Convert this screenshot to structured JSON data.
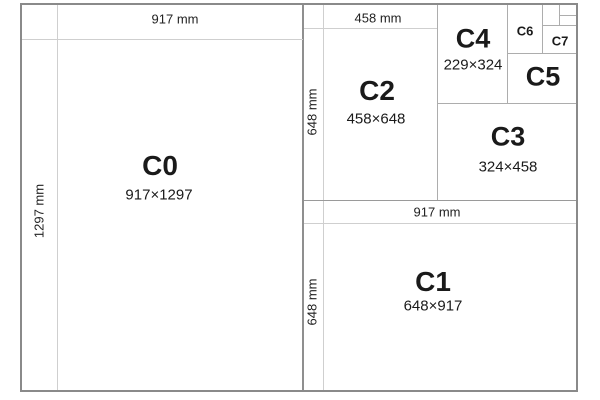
{
  "sheets": {
    "c0": {
      "name": "C0",
      "size": "917×1297",
      "width_label": "917 mm",
      "height_label": "1297 mm"
    },
    "c1": {
      "name": "C1",
      "size": "648×917",
      "width_label": "917 mm",
      "height_label": "648 mm"
    },
    "c2": {
      "name": "C2",
      "size": "458×648",
      "width_label": "458 mm",
      "height_label": "648 mm"
    },
    "c3": {
      "name": "C3",
      "size": "324×458"
    },
    "c4": {
      "name": "C4",
      "size": "229×324"
    },
    "c5": {
      "name": "C5"
    },
    "c6": {
      "name": "C6"
    },
    "c7": {
      "name": "C7"
    }
  },
  "colors": {
    "background": "#ffffff",
    "text": "#1a1a1a",
    "outer_border": "#8a8a8a",
    "sheet_divider": "#8f8f8f",
    "box_line": "#adadad",
    "strip_line": "#cfcfcf"
  }
}
